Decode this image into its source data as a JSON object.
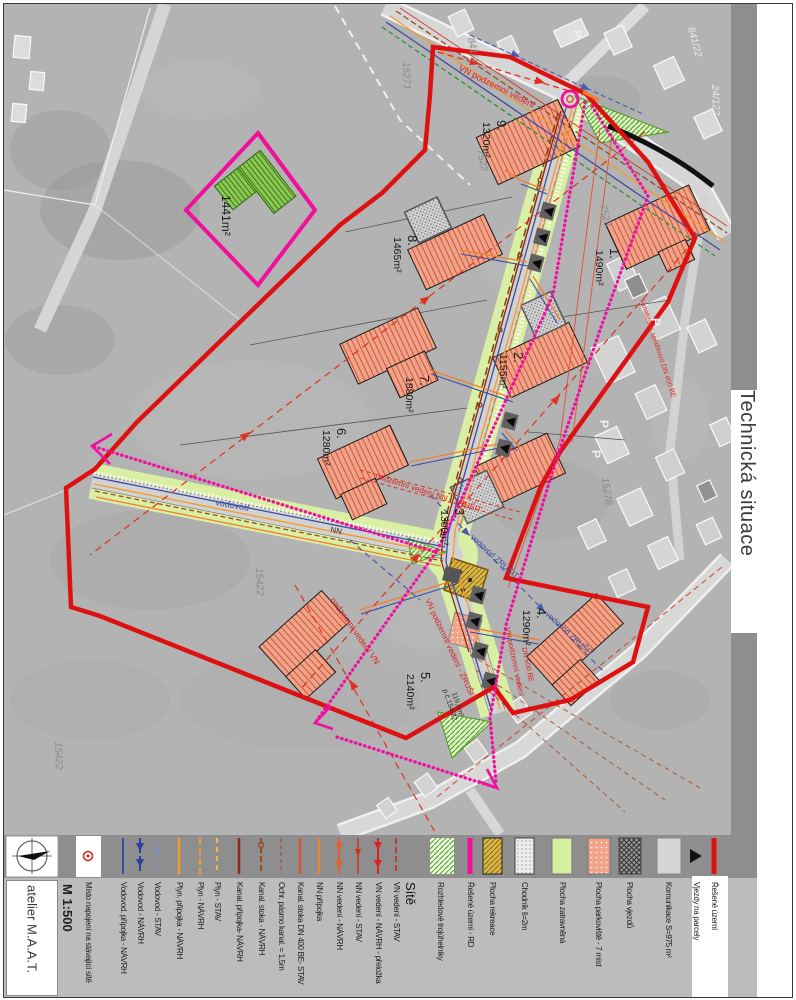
{
  "title": "Technická situace",
  "studio": "atelier M.A.A.T.",
  "scale": "M 1:500",
  "legend": {
    "sites_header": "Sítě",
    "misto": "Místo napojení na stávající sítě",
    "items": [
      {
        "label": "Vodovod. přípojka - NÁVRH"
      },
      {
        "label": "Vodovod - NÁVRH"
      },
      {
        "label": "Vodovod - STAV"
      },
      {
        "label": "Plyn. přípojka - NÁVRH"
      },
      {
        "label": "Plyn - NÁVRH"
      },
      {
        "label": "Plyn - STAV"
      },
      {
        "label": "Kanal. přípojka- NÁVRH"
      },
      {
        "label": "Kanal. stoka - NÁVRH"
      },
      {
        "label": "Ochr. pásmo kanal. = 1,5m"
      },
      {
        "label": "Kanal. stoka DN 400 BE- STAV"
      },
      {
        "label": "NN přípojka"
      },
      {
        "label": "NN vedení - NÁVRH"
      },
      {
        "label": "NN vedení - STAV"
      },
      {
        "label": "VN vedení - NÁVRH - přeložka"
      },
      {
        "label": "VN vedení - STAV"
      },
      {
        "label": "Rozhledové trojúhelníky"
      },
      {
        "label": "Řešené území - RD"
      },
      {
        "label": "Plocha rekreace"
      },
      {
        "label": "Chodník š=2m"
      },
      {
        "label": "Plocha zatravněná"
      },
      {
        "label": "Plocha parkoviště - 7 míst"
      },
      {
        "label": "Plocha vjezdů"
      },
      {
        "label": "Komunikace S=975 m²"
      },
      {
        "label": "Vjezdy na parcely"
      },
      {
        "label": "Řešené území"
      }
    ]
  },
  "parcels": [
    {
      "num": "1.",
      "area": "1490m²"
    },
    {
      "num": "2.",
      "area": "1155m²"
    },
    {
      "num": "3.",
      "area": "1300m²"
    },
    {
      "num": "4.",
      "area": "1290m²"
    },
    {
      "num": "5.",
      "area": "2140m²"
    },
    {
      "num": "6.",
      "area": "1280m²"
    },
    {
      "num": "7.",
      "area": "1880m²"
    },
    {
      "num": "8.",
      "area": "1465m²"
    },
    {
      "num": "9.",
      "area": "1320m²"
    }
  ],
  "special_parcel_area": "1441m²",
  "annotations": {
    "vn_podzemni": "VN podzemní vedení",
    "vn_podzemni_zrusit": "VN podzemní vedení - ZRUŠIT",
    "nadzemni_nn_zrusit": "nadzemní vedení NN - ZRUŠIT",
    "nadzemni_vn": "nadzemní vedení VN",
    "vodovod": "vodovod",
    "vodovod_zrusit": "vodovod ZRUŠIT",
    "pc15422": "p.č.154/22",
    "pc_area": "119,6m²",
    "dn600": "DN 600 BE",
    "kanalizace": "kanalizace splašková DN 400 BE",
    "nn": "NN",
    "p": "P"
  },
  "cadastral": {
    "c1": "15271",
    "c2": "841/4",
    "c3": "7522",
    "c4": "7523",
    "c5": "15422",
    "c6": "15278",
    "c7": "24/122",
    "c8": "841/22"
  },
  "colors": {
    "resene_uzemi": "#dd1111",
    "resene_uzemi_rd": "#f0109a",
    "zatravnena": "#d9efa3",
    "rekreace": "#d9b84a",
    "parkoviste": "#f2a289",
    "vodovod": "#3b4ea0",
    "plyn": "#f49a2a",
    "kanalizace": "#8c2a1a",
    "nn": "#e06030",
    "vn": "#e02020"
  }
}
